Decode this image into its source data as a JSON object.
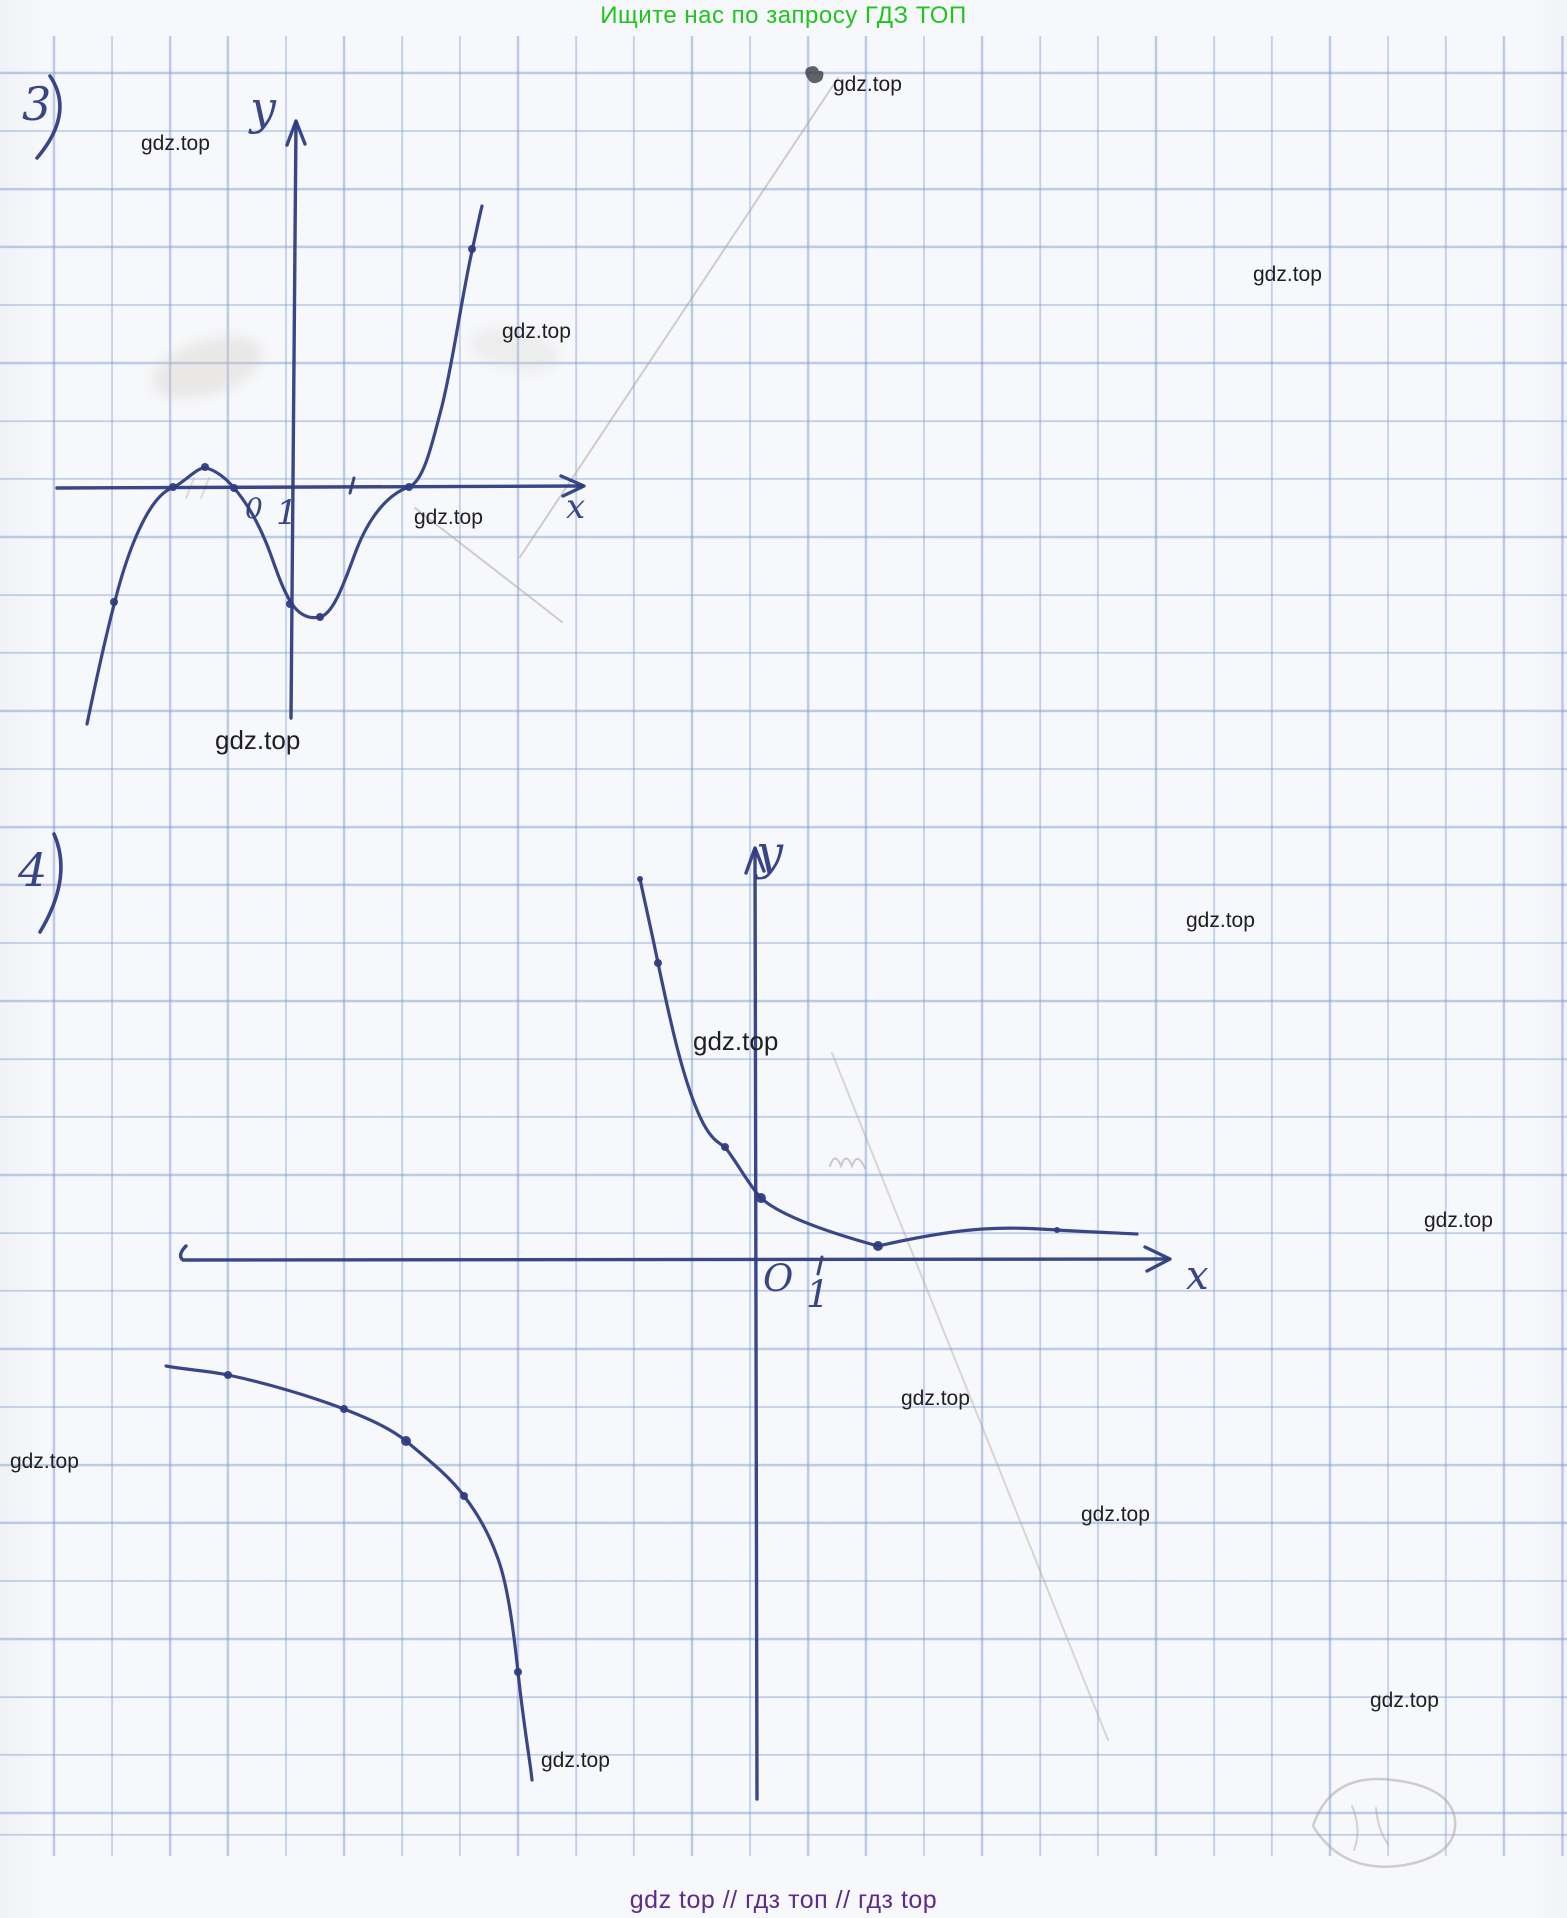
{
  "page": {
    "width": 1567,
    "height": 1918,
    "paper_color": "#f7f8fb",
    "grid_color": "rgba(126,152,208,0.48)",
    "ink_color": "#2e3d80",
    "watermark_color": "#1f1f1f",
    "header_green": "#1fc41f",
    "footer_purple": "#5c2b8c"
  },
  "header": {
    "text": "Ищите нас по запросу ГДЗ ТОП"
  },
  "footer": {
    "text": "gdz top  //  гдз топ  //  гдз top"
  },
  "watermarks": {
    "text": "gdz.top",
    "items": [
      {
        "x": 833,
        "y": 74,
        "size": 21
      },
      {
        "x": 141,
        "y": 133,
        "size": 21
      },
      {
        "x": 1253,
        "y": 264,
        "size": 21
      },
      {
        "x": 502,
        "y": 321,
        "size": 21
      },
      {
        "x": 414,
        "y": 507,
        "size": 21
      },
      {
        "x": 215,
        "y": 727,
        "size": 26
      },
      {
        "x": 1186,
        "y": 910,
        "size": 21
      },
      {
        "x": 693,
        "y": 1028,
        "size": 26
      },
      {
        "x": 1424,
        "y": 1210,
        "size": 21
      },
      {
        "x": 901,
        "y": 1388,
        "size": 21
      },
      {
        "x": 10,
        "y": 1451,
        "size": 21
      },
      {
        "x": 1081,
        "y": 1504,
        "size": 21
      },
      {
        "x": 1370,
        "y": 1690,
        "size": 21
      },
      {
        "x": 541,
        "y": 1750,
        "size": 21
      }
    ]
  },
  "annotations": [
    {
      "text": "3",
      "x": 22,
      "y": 84,
      "size": 46
    },
    {
      "text": "4",
      "x": 18,
      "y": 850,
      "size": 46
    },
    {
      "text": "у",
      "x": 250,
      "y": 88,
      "size": 46
    },
    {
      "text": "х",
      "x": 566,
      "y": 492,
      "size": 34
    },
    {
      "text": "0",
      "x": 245,
      "y": 496,
      "size": 28
    },
    {
      "text": "1",
      "x": 276,
      "y": 498,
      "size": 34
    },
    {
      "text": "у",
      "x": 756,
      "y": 832,
      "size": 48
    },
    {
      "text": "х",
      "x": 1186,
      "y": 1258,
      "size": 40
    },
    {
      "text": "O",
      "x": 763,
      "y": 1262,
      "size": 37
    },
    {
      "text": "1",
      "x": 806,
      "y": 1278,
      "size": 37
    }
  ],
  "graphs": {
    "g3": {
      "axis_x": "M 57 488 L 582 486",
      "arrow_x": "M 561 476 L 584 486 L 563 496",
      "axis_y": "M 296 122 L 291 718",
      "arrow_y": "M 287 145 L 296 121 L 305 144",
      "tick": "M 354 478 L 350 493",
      "paren": "M 50 76 Q 75 113 37 158",
      "curve": "M 87 724 C 97 676 106 635 115 601 C 127 553 148 497 172 488 C 184 483 198 466 206 468 C 215 470 226 478 234 488 C 247 503 257 521 265 540 C 273 558 280 586 292 604 C 301 617 311 619 320 617 C 334 614 345 580 356 551 C 369 517 388 494 409 487 C 424 481 432 444 442 406 C 453 362 461 301 472 251 C 476 233 479 218 482 206"
    },
    "g4": {
      "axis_x": "M 186 1246 C 180 1252 179 1257 183 1260 L 1168 1259",
      "arrow_x": "M 1145 1247 L 1170 1259 L 1147 1271",
      "axis_y": "M 755 849 L 757 1799",
      "arrow_y": "M 746 873 L 755 848 L 764 871",
      "tick": "M 822 1257 L 818 1274",
      "paren": "M 54 834 Q 73 877 40 932",
      "curve_right": "M 640 879 C 647 912 653 938 658 963 C 670 1020 684 1086 703 1123 C 711 1138 717 1142 725 1147 C 738 1164 749 1185 761 1198 C 783 1218 838 1235 878 1246 C 909 1239 950 1231 983 1229 C 1016 1227 1038 1229 1057 1230 C 1088 1232 1118 1233 1137 1234",
      "curve_left": "M 166 1366 C 188 1370 210 1371 228 1375 C 266 1383 310 1396 344 1409 C 372 1420 391 1429 406 1441 C 430 1461 450 1477 464 1496 C 478 1514 489 1534 497 1556 C 507 1582 513 1625 518 1672 C 521 1700 524 1722 527 1743 C 529 1757 531 1770 532 1780"
    },
    "dots": [
      [
        114,
        602,
        4
      ],
      [
        173,
        487,
        4
      ],
      [
        205,
        467,
        4
      ],
      [
        234,
        488,
        4
      ],
      [
        290,
        604,
        4
      ],
      [
        320,
        617,
        4
      ],
      [
        409,
        487,
        4
      ],
      [
        472,
        249,
        4
      ],
      [
        640,
        879,
        3
      ],
      [
        658,
        963,
        4
      ],
      [
        725,
        1147,
        4
      ],
      [
        761,
        1198,
        5
      ],
      [
        878,
        1246,
        5
      ],
      [
        1057,
        1230,
        3
      ],
      [
        228,
        1375,
        4
      ],
      [
        344,
        1409,
        4
      ],
      [
        406,
        1441,
        5
      ],
      [
        464,
        1496,
        4
      ],
      [
        518,
        1672,
        4
      ]
    ]
  },
  "pencil": [
    {
      "d": "M 520 557 L 838 78"
    },
    {
      "d": "M 415 508 L 562 622"
    },
    {
      "d": "M 832 1053 L 1108 1740",
      "opacity": 0.4
    },
    {
      "d": "M 830 1166 q 5 -15 11 0 q 5 -15 11 0 q 5 -15 13 2",
      "opacity": 0.55
    },
    {
      "d": "M 1313 1826 q 18 -54 80 -46 q 58 7 62 40 q 3 35 -50 45 q -62 10 -92 -39",
      "width": 2.5,
      "opacity": 0.5
    },
    {
      "d": "M 1352 1806 q 10 24 2 44 m 22 -42 q 2 22 12 36",
      "opacity": 0.45
    },
    {
      "d": "M 186 498 l 8 -20 m 7 20 l 8 -20",
      "opacity": 0.35
    },
    {
      "d": "M 807 68 q 9 -5 12 3 q 7 -1 3 9 q -9 7 -14 -1 q -5 -7 -1 -11",
      "fill": "#3b3b44",
      "stroke": "none",
      "opacity": 0.8
    }
  ]
}
